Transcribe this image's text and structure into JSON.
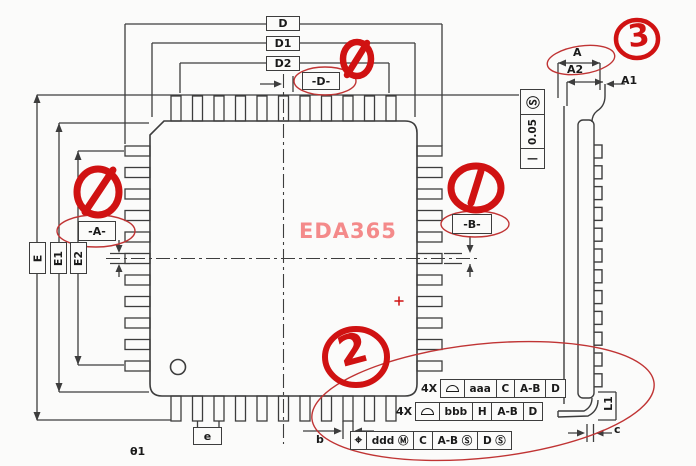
{
  "watermark": "EDA365",
  "top_view": {
    "dims": {
      "d": "D",
      "d1": "D1",
      "d2": "D2",
      "e_dim": "E",
      "e1": "E1",
      "e2": "E2"
    },
    "datums": {
      "a": "-A-",
      "b": "-B-",
      "d": "-D-"
    },
    "pitch_label": "e",
    "lead_width_label": "b",
    "angle_label": "θ1"
  },
  "side_view": {
    "overall_height_label": "A",
    "standoff_label": "A1",
    "body_height_label": "A2",
    "straightness": {
      "symbol": "—",
      "value": "0.05",
      "modifier": "Ⓢ"
    },
    "foot_length_label": "L1",
    "lead_thickness_label": "c"
  },
  "fcf_frames": [
    {
      "prefix": "4X",
      "symbol": "profile-of-surface",
      "cells": [
        "aaa",
        "C",
        "A-B",
        "D"
      ]
    },
    {
      "prefix": "4X",
      "symbol": "profile-of-surface",
      "cells": [
        "bbb",
        "H",
        "A-B",
        "D"
      ]
    },
    {
      "prefix": "",
      "symbol": "position",
      "position_symbol": "⌖",
      "cells": [
        "ddd Ⓜ",
        "C",
        "A-B Ⓢ",
        "D Ⓢ"
      ]
    }
  ],
  "red_annotations": {
    "note_2": "2",
    "note_3": "3"
  },
  "colors": {
    "line": "#3d3d3d",
    "red_thick": "#d01212",
    "red_thin": "#c03434",
    "watermark": "#f48a8a",
    "background": "#fbfbfa"
  }
}
